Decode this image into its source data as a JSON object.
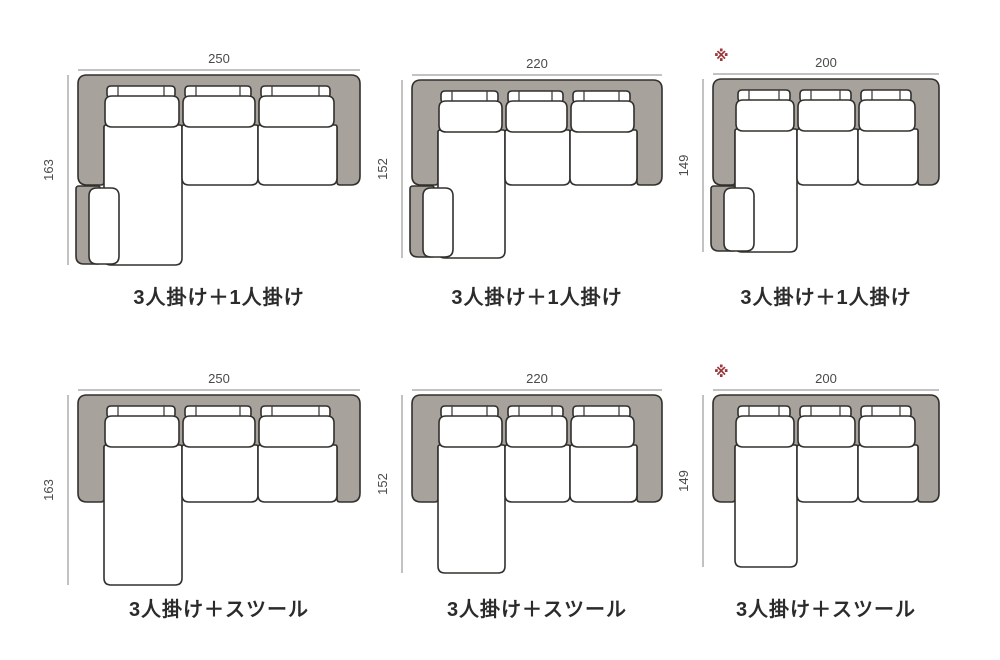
{
  "page": {
    "background": "#ffffff"
  },
  "palette": {
    "sofa_gray": "#a7a29c",
    "outline": "#32302d",
    "cushion_white": "#ffffff",
    "dim_line": "#848484",
    "dim_text": "#4a4a4a",
    "caption_text": "#2b2b2b",
    "note_red": "#9a393c"
  },
  "diagrams": [
    {
      "id": "sofa-3seat-plus-1seat-250",
      "caption": "3人掛け＋1人掛け",
      "width_label": "250",
      "height_label": "163",
      "note_mark": ""
    },
    {
      "id": "sofa-3seat-plus-1seat-220",
      "caption": "3人掛け＋1人掛け",
      "width_label": "220",
      "height_label": "152",
      "note_mark": ""
    },
    {
      "id": "sofa-3seat-plus-1seat-200",
      "caption": "3人掛け＋1人掛け",
      "width_label": "200",
      "height_label": "149",
      "note_mark": "※"
    },
    {
      "id": "sofa-3seat-plus-stool-250",
      "caption": "3人掛け＋スツール",
      "width_label": "250",
      "height_label": "163",
      "note_mark": ""
    },
    {
      "id": "sofa-3seat-plus-stool-220",
      "caption": "3人掛け＋スツール",
      "width_label": "220",
      "height_label": "152",
      "note_mark": ""
    },
    {
      "id": "sofa-3seat-plus-stool-200",
      "caption": "3人掛け＋スツール",
      "width_label": "200",
      "height_label": "149",
      "note_mark": "※"
    }
  ]
}
